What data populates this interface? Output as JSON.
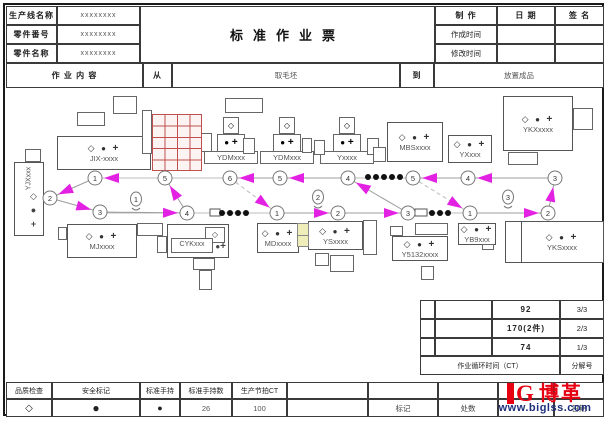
{
  "header": {
    "fields": [
      {
        "label": "生产线名称",
        "value": "xxxxxxxx"
      },
      {
        "label": "零件番号",
        "value": "xxxxxxxx"
      },
      {
        "label": "零件名称",
        "value": "xxxxxxxx"
      }
    ],
    "title": "标准作业票",
    "make_label": "制 作",
    "date_label": "日 期",
    "sign_label": "签 名",
    "created_label": "作成时间",
    "modified_label": "修改时间",
    "work_content_label": "作 业 内 容",
    "from_label": "从",
    "from_value": "取毛坯",
    "to_label": "到",
    "to_value": "放置成品"
  },
  "summary": {
    "rows": [
      [
        "92",
        "3/3"
      ],
      [
        "170(2件)",
        "2/3"
      ],
      [
        "74",
        "1/3"
      ]
    ],
    "footer": [
      "作业循环时间（CT）",
      "分解号"
    ]
  },
  "legend": {
    "items": [
      {
        "label": "品质检查",
        "symbol": "◇"
      },
      {
        "label": "安全标记",
        "symbol": "●"
      },
      {
        "label": "标准手持",
        "symbol": "●"
      },
      {
        "label": "标准手持数",
        "value": "26"
      },
      {
        "label": "生产节拍CT",
        "value": "100"
      }
    ]
  },
  "footer": {
    "mark_label": "标记",
    "places_label": "处数",
    "date_label": "日期"
  },
  "logo": {
    "brand": "博革",
    "site": "www.biglss.com",
    "brand_color": "#e60012",
    "site_color": "#1d2f7c"
  },
  "colors": {
    "arrow": "#e321e3",
    "line": "#9c9c9c",
    "light": "#bcbcbc",
    "grid_red": "#c0504d",
    "circle_stroke": "#777777"
  },
  "diagram": {
    "machines": [
      {
        "name": "yjx",
        "label": "YJXxxx",
        "kind": "vertical",
        "x": 14,
        "y": 162,
        "w": 30,
        "h": 74
      },
      {
        "name": "jix",
        "label": "JIX-xxxx",
        "kind": "box",
        "x": 57,
        "y": 136,
        "w": 94,
        "h": 34
      },
      {
        "name": "ydm1",
        "label": "YDMxxx",
        "kind": "cross",
        "cx": 231
      },
      {
        "name": "ydm2",
        "label": "YDMxxx",
        "kind": "cross",
        "cx": 287
      },
      {
        "name": "y",
        "label": "Yxxxx",
        "kind": "cross",
        "cx": 347
      },
      {
        "name": "mbs",
        "label": "MBSxxxx",
        "kind": "box",
        "x": 387,
        "y": 122,
        "w": 56,
        "h": 40
      },
      {
        "name": "yx",
        "label": "YXxxx",
        "kind": "box",
        "x": 448,
        "y": 135,
        "w": 44,
        "h": 28
      },
      {
        "name": "ykx",
        "label": "YKXxxxx",
        "kind": "box",
        "x": 503,
        "y": 96,
        "w": 70,
        "h": 55
      },
      {
        "name": "mj",
        "label": "MJxxxx",
        "kind": "box",
        "x": 67,
        "y": 224,
        "w": 70,
        "h": 34
      },
      {
        "name": "cyk",
        "label": "CYKxxx",
        "kind": "cyk",
        "x": 167,
        "y": 224,
        "w": 62,
        "h": 34
      },
      {
        "name": "md",
        "label": "MDxxxx",
        "kind": "box",
        "x": 257,
        "y": 223,
        "w": 42,
        "h": 30
      },
      {
        "name": "ys",
        "label": "YSxxxx",
        "kind": "box",
        "x": 308,
        "y": 221,
        "w": 55,
        "h": 29
      },
      {
        "name": "y5132",
        "label": "Y5132xxxx",
        "kind": "box",
        "x": 392,
        "y": 236,
        "w": 56,
        "h": 25
      },
      {
        "name": "yb9",
        "label": "YB9xxx",
        "kind": "box",
        "x": 458,
        "y": 223,
        "w": 38,
        "h": 22
      },
      {
        "name": "yks",
        "label": "YKSxxxx",
        "kind": "strip",
        "x": 505,
        "y": 221,
        "w": 99,
        "h": 42
      }
    ],
    "extras": [
      [
        77,
        112,
        28,
        14
      ],
      [
        113,
        96,
        24,
        18
      ],
      [
        225,
        98,
        38,
        15
      ],
      [
        142,
        110,
        10,
        44
      ],
      [
        25,
        149,
        16,
        13
      ],
      [
        200,
        133,
        12,
        19
      ],
      [
        243,
        138,
        12,
        16
      ],
      [
        302,
        138,
        10,
        15
      ],
      [
        314,
        140,
        11,
        15
      ],
      [
        367,
        138,
        12,
        17
      ],
      [
        373,
        147,
        13,
        15
      ],
      [
        573,
        108,
        20,
        22
      ],
      [
        508,
        152,
        30,
        13
      ],
      [
        58,
        227,
        9,
        13
      ],
      [
        137,
        223,
        26,
        13
      ],
      [
        157,
        236,
        10,
        17
      ],
      [
        193,
        258,
        22,
        12
      ],
      [
        199,
        270,
        13,
        20
      ],
      [
        363,
        220,
        14,
        35
      ],
      [
        315,
        253,
        14,
        13
      ],
      [
        330,
        255,
        24,
        17
      ],
      [
        390,
        226,
        13,
        10
      ],
      [
        415,
        223,
        33,
        12
      ],
      [
        421,
        266,
        13,
        14
      ],
      [
        482,
        244,
        12,
        6
      ]
    ],
    "red_grid": {
      "x": 152,
      "y": 114,
      "w": 50,
      "h": 57,
      "cols": 4,
      "rows": 5
    },
    "yellow_cells": {
      "x": 297,
      "y": 223,
      "w": 12,
      "h": 24,
      "rows": 2
    },
    "baselines": [
      [
        95,
        178,
        555,
        178
      ],
      [
        100,
        213,
        548,
        213
      ]
    ],
    "loops": [
      {
        "operator": {
          "n": "1",
          "x": 136,
          "y": 199
        },
        "steps": [
          {
            "n": "1",
            "x": 95,
            "y": 178
          },
          {
            "n": "2",
            "x": 50,
            "y": 198
          },
          {
            "n": "3",
            "x": 100,
            "y": 212
          },
          {
            "n": "4",
            "x": 187,
            "y": 213
          },
          {
            "n": "5",
            "x": 165,
            "y": 178
          }
        ]
      },
      {
        "operator": {
          "n": "2",
          "x": 318,
          "y": 197
        },
        "steps": [
          {
            "n": "1",
            "x": 277,
            "y": 213
          },
          {
            "n": "2",
            "x": 338,
            "y": 213
          },
          {
            "n": "3",
            "x": 408,
            "y": 213
          },
          {
            "n": "4",
            "x": 348,
            "y": 178
          },
          {
            "n": "5",
            "x": 280,
            "y": 178
          },
          {
            "n": "6",
            "x": 230,
            "y": 178
          }
        ]
      },
      {
        "operator": {
          "n": "3",
          "x": 508,
          "y": 197
        },
        "steps": [
          {
            "n": "1",
            "x": 470,
            "y": 213
          },
          {
            "n": "2",
            "x": 548,
            "y": 213
          },
          {
            "n": "3",
            "x": 555,
            "y": 178
          },
          {
            "n": "4",
            "x": 468,
            "y": 178
          },
          {
            "n": "5",
            "x": 413,
            "y": 178
          }
        ]
      }
    ],
    "wip": {
      "top_dots": {
        "y": 177,
        "xs": [
          368,
          376,
          384,
          392,
          400
        ]
      },
      "groups": [
        {
          "rect": [
            210,
            209,
            10,
            7
          ],
          "dots_y": 213,
          "dots_x": [
            222,
            230,
            238,
            246
          ]
        },
        {
          "rect": [
            415,
            209,
            12,
            7
          ],
          "dots_y": 213,
          "dots_x": [
            432,
            440,
            448
          ]
        }
      ]
    }
  }
}
